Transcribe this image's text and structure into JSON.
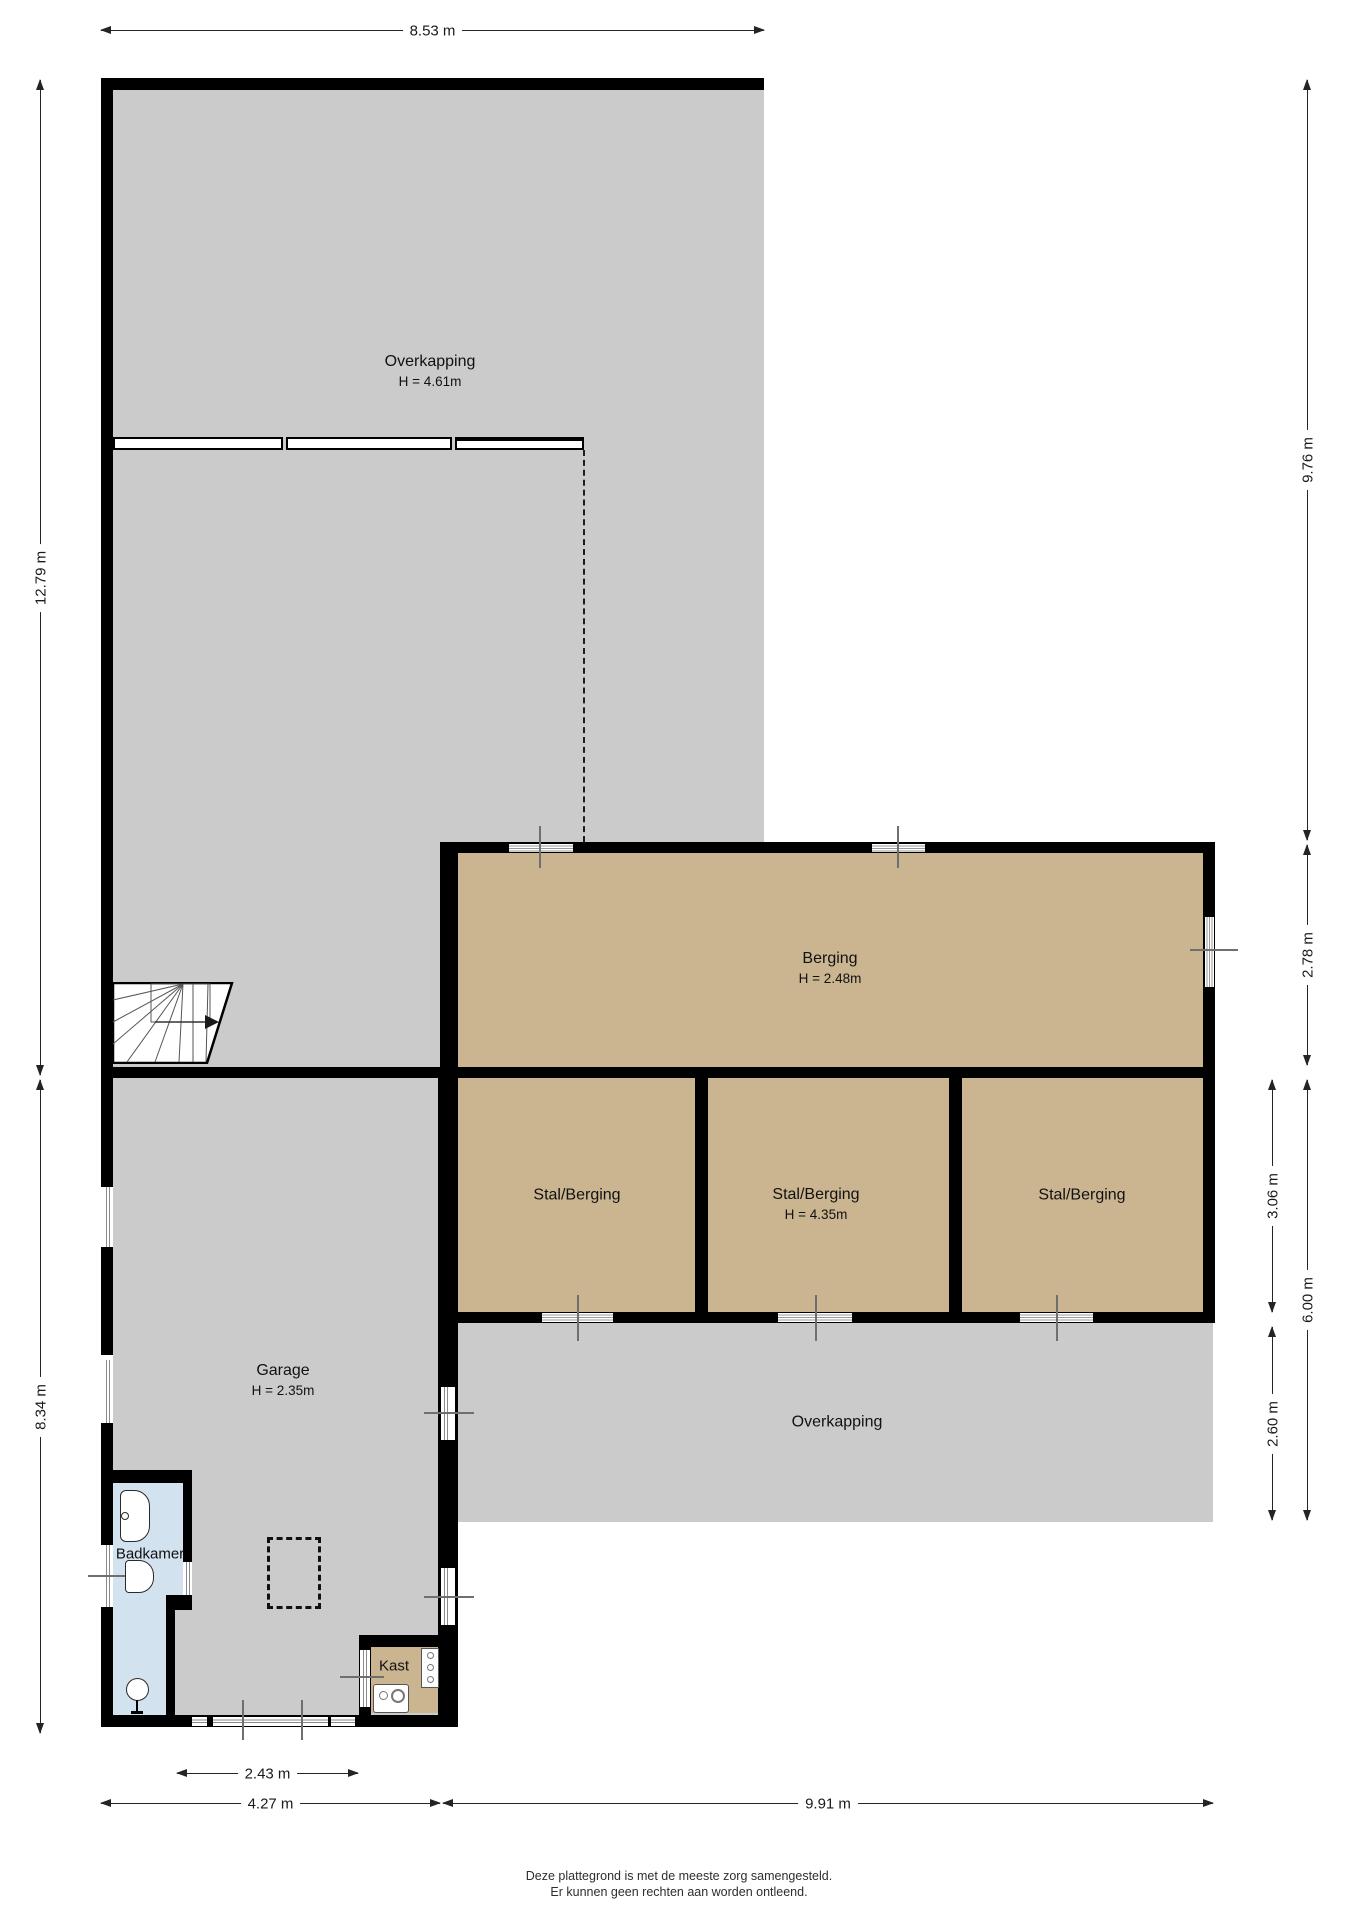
{
  "plan": {
    "rooms": {
      "overkapping_top": {
        "name": "Overkapping",
        "height": "H = 4.61m"
      },
      "berging": {
        "name": "Berging",
        "height": "H = 2.48m"
      },
      "stal1": {
        "name": "Stal/Berging"
      },
      "stal2": {
        "name": "Stal/Berging",
        "height": "H = 4.35m"
      },
      "stal3": {
        "name": "Stal/Berging"
      },
      "overkapping_bottom": {
        "name": "Overkapping"
      },
      "garage": {
        "name": "Garage",
        "height": "H = 2.35m"
      },
      "badkamer": {
        "name": "Badkamer"
      },
      "kast": {
        "name": "Kast"
      }
    },
    "dimensions": {
      "top": "8.53 m",
      "left_upper": "12.79 m",
      "left_lower": "8.34 m",
      "right_upper": "9.76 m",
      "right_berging": "2.78 m",
      "right_stal": "3.06 m",
      "right_total": "6.00 m",
      "right_overkapping": "2.60 m",
      "bottom_window": "2.43 m",
      "bottom_left": "4.27 m",
      "bottom_right": "9.91 m"
    },
    "footer": {
      "line1": "Deze plattegrond is met de meeste zorg samengesteld.",
      "line2": "Er kunnen geen rechten aan worden ontleend."
    },
    "colors": {
      "covered": "#cbcbcb",
      "storage": "#cbb591",
      "bath": "#d3e2ef",
      "wall": "#000000"
    }
  }
}
